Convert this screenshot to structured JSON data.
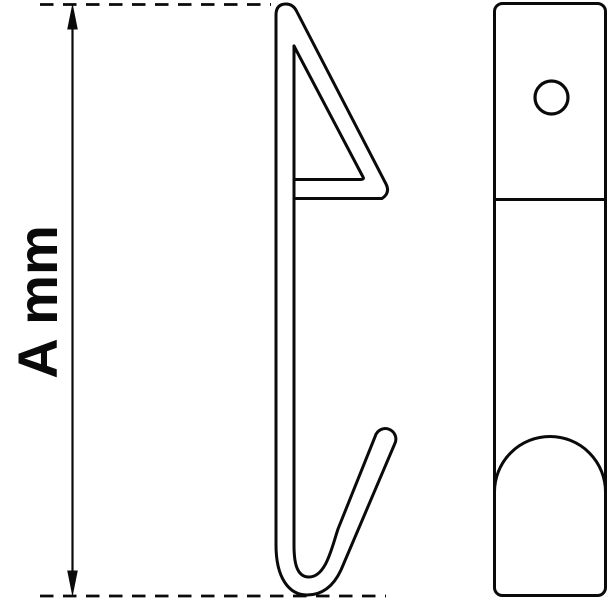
{
  "canvas": {
    "background": "#ffffff",
    "line_color": "#0a0a0a"
  },
  "dimension": {
    "label": "A mm"
  }
}
